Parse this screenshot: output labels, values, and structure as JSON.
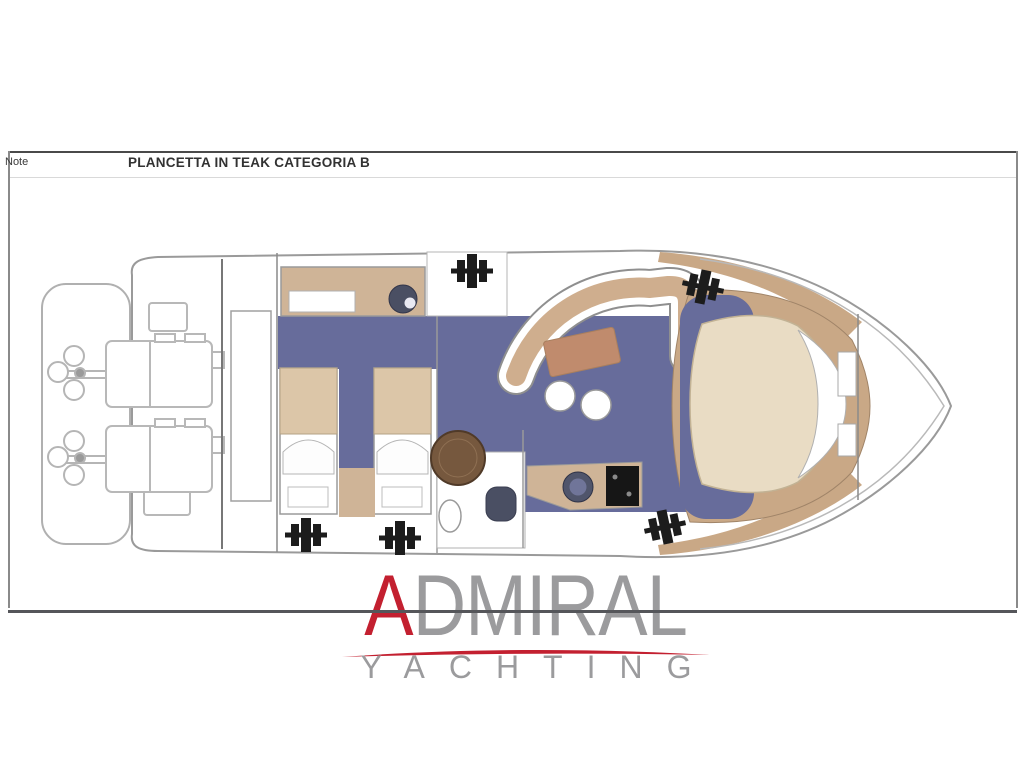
{
  "note_bar": {
    "label": "Note",
    "title": "PLANCETTA IN TEAK CATEGORIA B"
  },
  "logo": {
    "brand_first_letter": "A",
    "brand_rest": "DMIRAL",
    "subtitle": "YACHTING"
  },
  "colors": {
    "logo_red": "#c32030",
    "logo_gray": "#9b9b9d",
    "line_dark": "#55565a",
    "outline_gray": "#9a9a9a",
    "carpet_blue": "#676c9b",
    "teak": "#c9a886",
    "cabinet_tan": "#cfb497",
    "blanket_tan": "#dcc6a8",
    "bed_cream": "#e9dcc4",
    "table_brown": "#76583e",
    "salon_table": "#c08b6d",
    "dark_fixture": "#4a4f63",
    "hatch_black": "#1c1c1c"
  }
}
